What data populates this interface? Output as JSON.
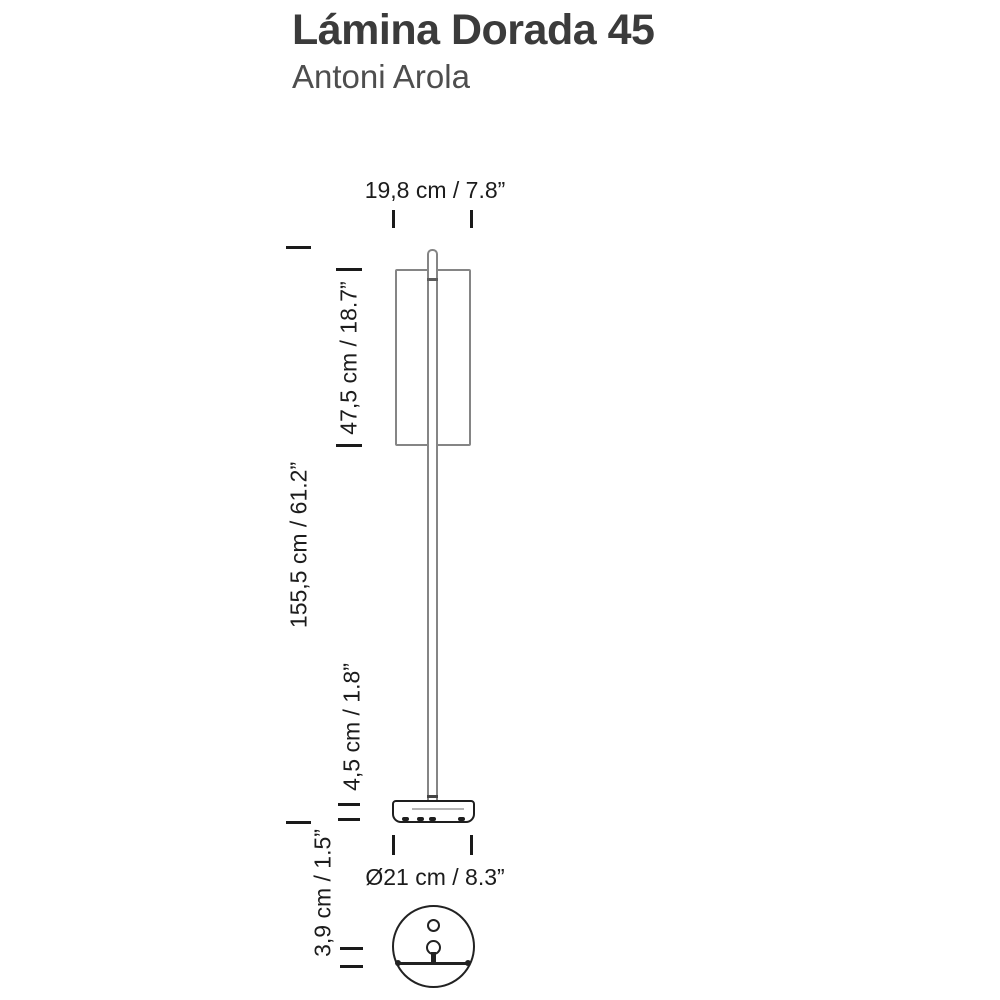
{
  "header": {
    "title": "Lámina Dorada 45",
    "designer": "Antoni Arola"
  },
  "drawing": {
    "dim_shade_width": "19,8 cm / 7.8”",
    "dim_shade_height": "47,5 cm / 18.7”",
    "dim_total_height": "155,5 cm / 61.2”",
    "dim_stem_clearance": "4,5 cm / 1.8”",
    "dim_base_height": "3,9 cm / 1.5”",
    "dim_base_diameter": "Ø21 cm / 8.3”"
  },
  "colors": {
    "background": "#ffffff",
    "title_text": "#3b3b3b",
    "designer_text": "#4e4e4e",
    "dimension_text": "#1c1c1c",
    "outline_light_gray": "#858585",
    "outline_dark": "#1e1e1e"
  }
}
